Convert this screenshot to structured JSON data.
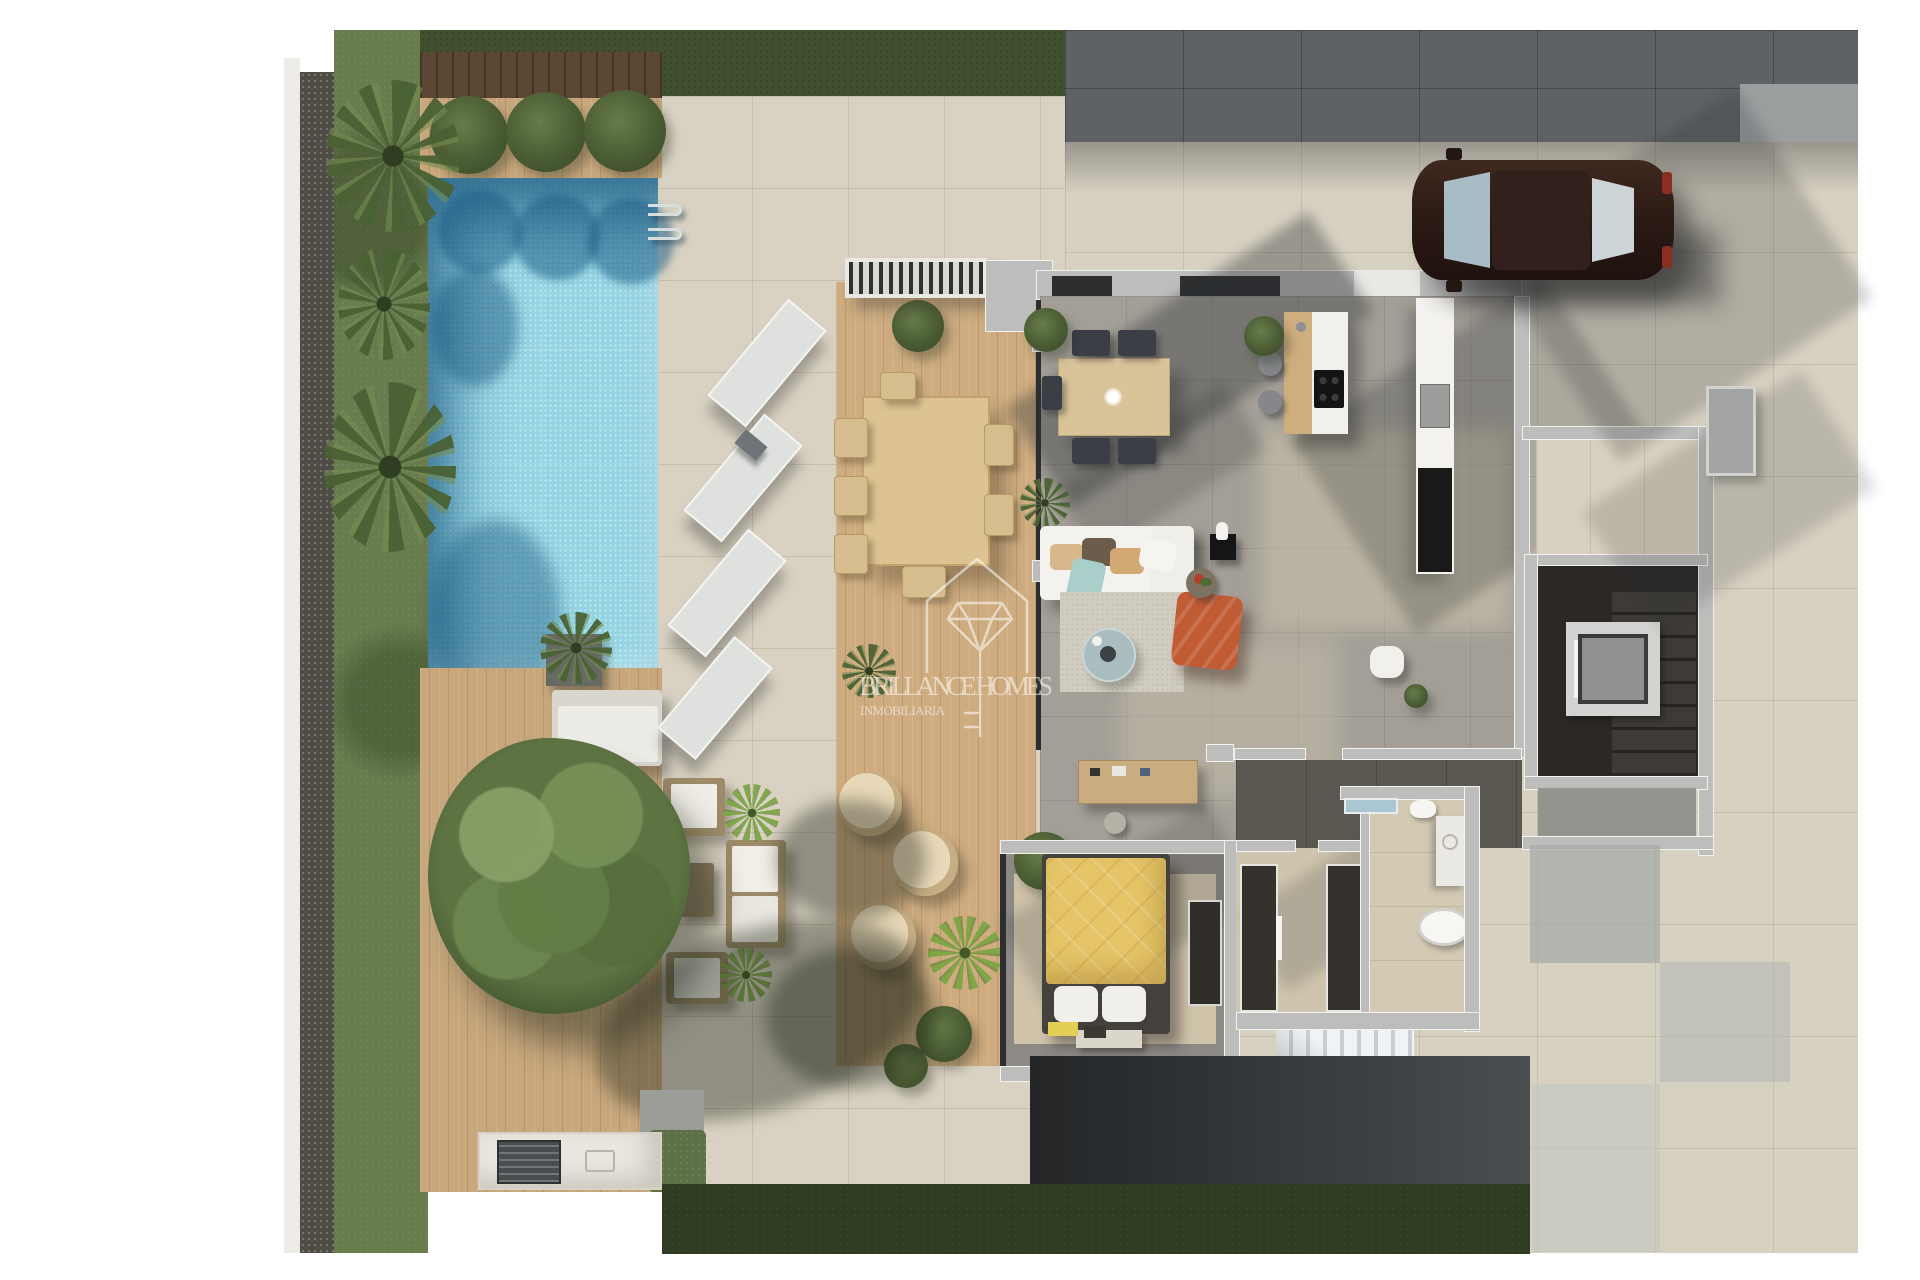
{
  "watermark": {
    "brand_line": "BRILLANCE HOMES",
    "subtitle_line": "INMOBILIARIA"
  },
  "scene": {
    "kind": "3D rendered ground-floor plan, top-down view",
    "areas": [
      "swimming pool",
      "pool deck with sun loungers",
      "gravel border and palm garden",
      "wood deck with large tree and lounge set",
      "terrace with outdoor dining table and wicker chairs",
      "open-plan living, dining and kitchen",
      "bedroom with yellow bed and wardrobe",
      "bathroom with tub, shower and vanity",
      "two closets and hallway",
      "elevator and staircases",
      "driveway with parked car",
      "outdoor bbq counter"
    ]
  },
  "palette": {
    "pool_water": "#93d4e3",
    "pool_shadow": "#16547a",
    "terrace_tile": "#d9d2c3",
    "wood_deck": "#c8a77c",
    "lawn_dark": "#41502f",
    "garden_green": "#697c4e",
    "gravel": "#4f4c45",
    "interior_concrete": "#a39f97",
    "wall_gray": "#bdbdbb",
    "dark_paving": "#5e6265",
    "driveway": "#d7d1c2",
    "bed_duvet_yellow": "#e5c568",
    "pouf_orange": "#bf5a33",
    "car_body": "#2d1b15",
    "elevator_cab": "#909090",
    "watermark_white": "#ffffff"
  }
}
